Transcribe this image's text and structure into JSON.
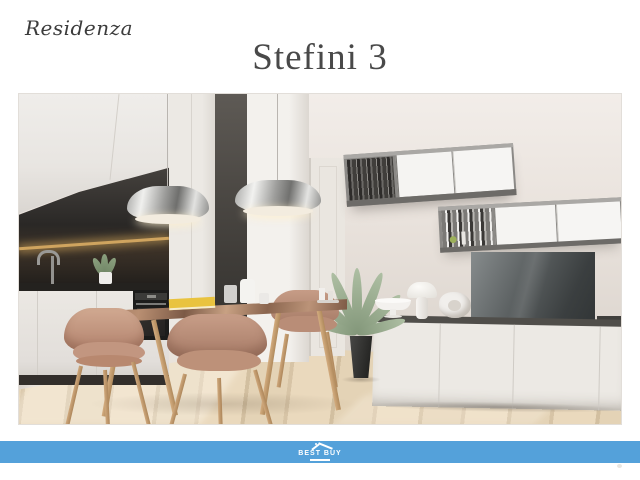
{
  "header": {
    "brand": "Residenza",
    "title": "Stefini 3"
  },
  "photo": {
    "description": "3D render of a modern apartment interior: white kitchen with dark backsplash and oven, two chrome pendant lamps, marble-top dining table with tan leather chairs and a yellow book, wall-mounted gray shelf units with books, TV on a white sideboard with white lamp, bowl and sculpture, potted plant, light wood floor"
  },
  "footer": {
    "logo_text": "BEST BUY",
    "logo_icon": "house-roof-icon"
  },
  "colors": {
    "footer_bar_blue": "#54a1da",
    "title_text": "#494949",
    "brand_text": "#3c3c3c",
    "page_background": "#ffffff"
  }
}
